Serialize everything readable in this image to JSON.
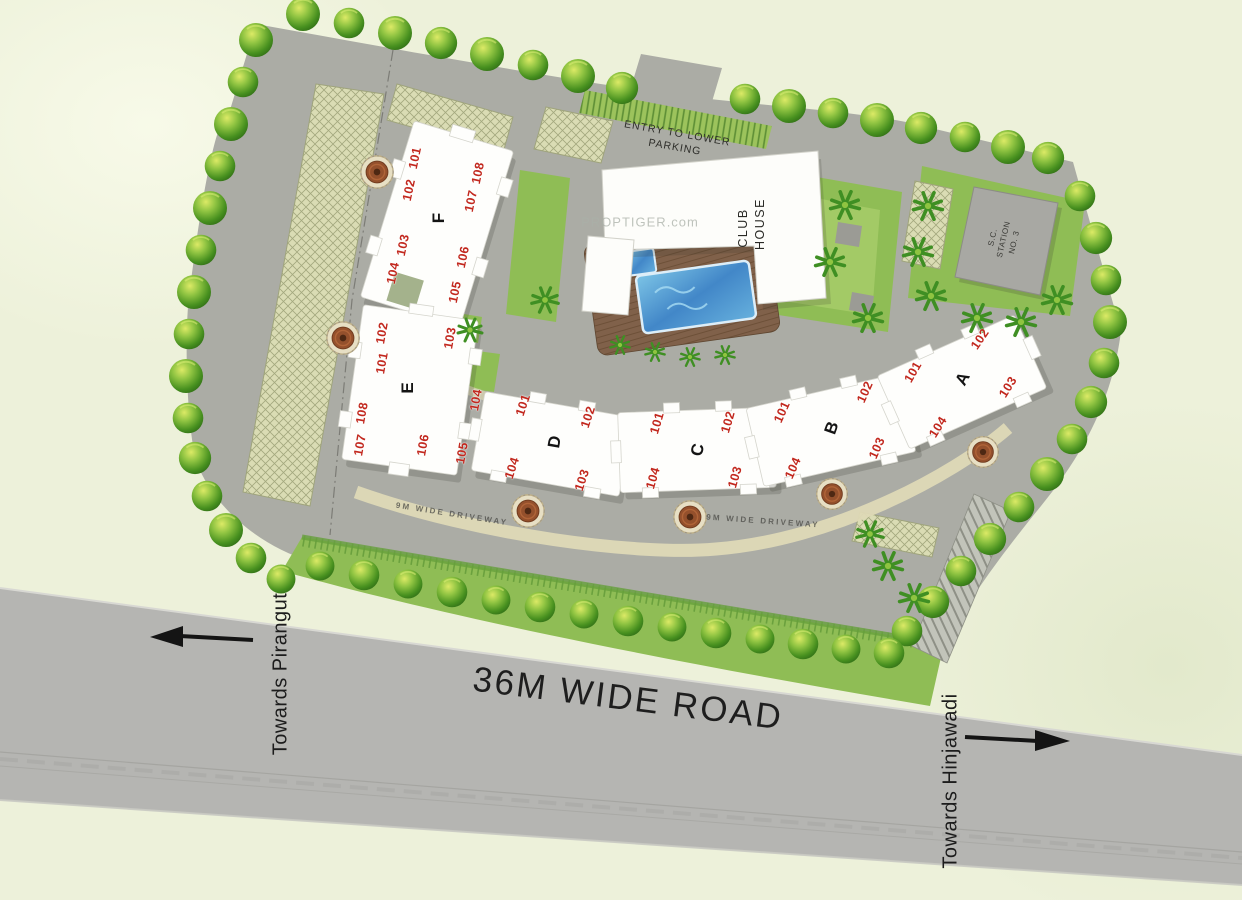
{
  "plan": {
    "road_label": "36M WIDE ROAD",
    "direction_left": "Towards Pirangut",
    "direction_right": "Towards Hinjawadi",
    "driveway_label": "9M WIDE DRIVEWAY",
    "entry_label": "ENTRY TO LOWER PARKING",
    "clubhouse_label": "CLUB HOUSE",
    "station_label": "S.C. STATION NO. 3",
    "watermark": "PROPTIGER.com"
  },
  "buildings": [
    {
      "label": "F",
      "units": [
        "101",
        "102",
        "103",
        "104",
        "105",
        "106",
        "107",
        "108"
      ]
    },
    {
      "label": "E",
      "units": [
        "101",
        "102",
        "103",
        "104",
        "105",
        "106",
        "107",
        "108"
      ]
    },
    {
      "label": "D",
      "units": [
        "101",
        "102",
        "103",
        "104"
      ]
    },
    {
      "label": "C",
      "units": [
        "101",
        "102",
        "103",
        "104"
      ]
    },
    {
      "label": "B",
      "units": [
        "101",
        "102",
        "103",
        "104"
      ]
    },
    {
      "label": "A",
      "units": [
        "101",
        "102",
        "103",
        "104"
      ]
    }
  ],
  "colors": {
    "background": "#edf1da",
    "road": "#b5b5b2",
    "site": "#abaca5",
    "lawn": "#8fbd55",
    "tree": "#47901f",
    "pool": "#4287c8",
    "deck": "#80614a",
    "building": "#fefefc",
    "unit_number": "#c2281e",
    "parking_hatch": "#dadcb4",
    "text": "#1e1e1e"
  }
}
